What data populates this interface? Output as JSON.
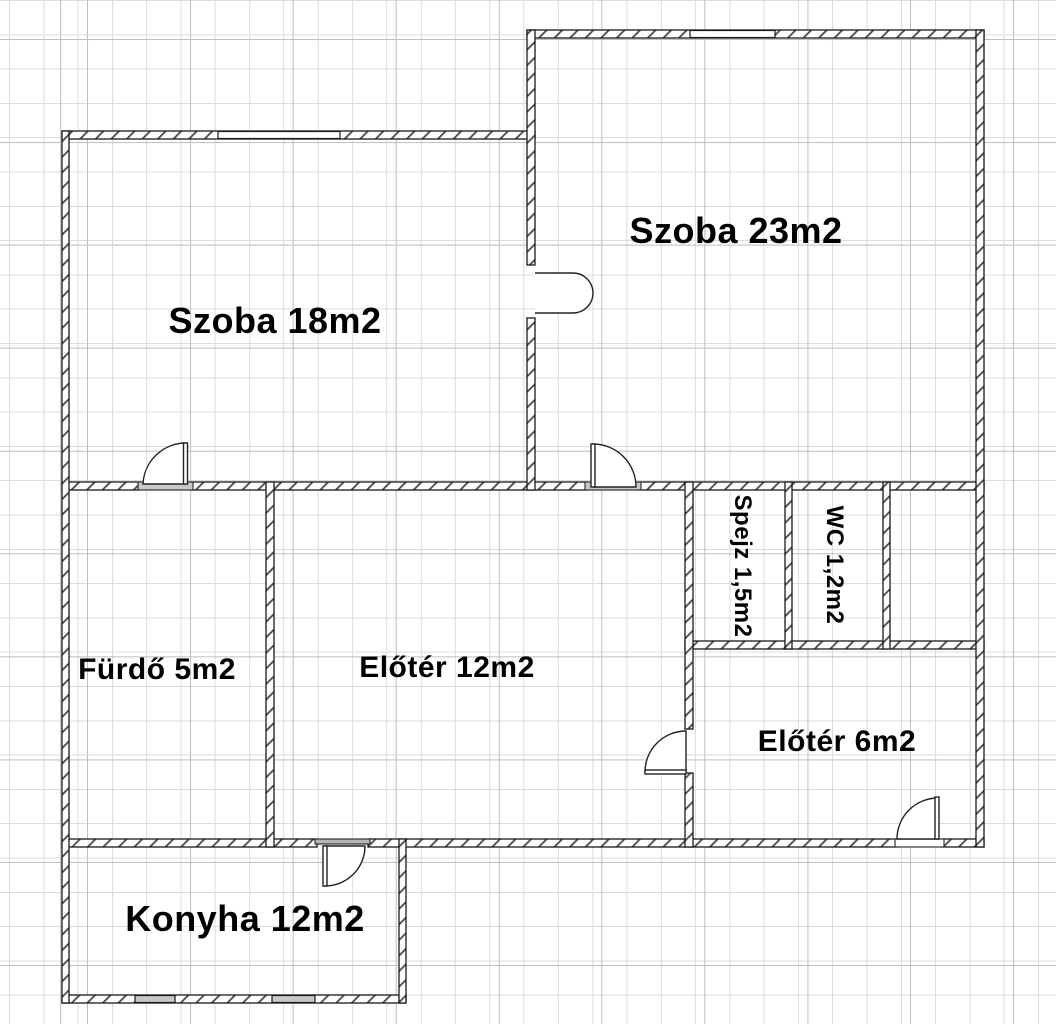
{
  "rooms": [
    {
      "id": "szoba-23",
      "label": "Szoba 23m2"
    },
    {
      "id": "szoba-18",
      "label": "Szoba 18m2"
    },
    {
      "id": "furdo",
      "label": "Fürdő 5m2"
    },
    {
      "id": "eloter-12",
      "label": "Előtér 12m2"
    },
    {
      "id": "spejz",
      "label": "Spejz 1,5m2"
    },
    {
      "id": "wc",
      "label": "WC 1,2m2"
    },
    {
      "id": "eloter-6",
      "label": "Előtér 6m2"
    },
    {
      "id": "konyha",
      "label": "Konyha 12m2"
    }
  ],
  "colors": {
    "background": "#ffffff",
    "grid_minor": "#dcdcdc",
    "grid_major": "#bfbfbf",
    "wall_line": "#1a1a1a",
    "wall_hatch": "#4a4a4a",
    "threshold_fill": "#c8c8c8",
    "window_fill": "#ffffff",
    "label_color": "#000000"
  }
}
